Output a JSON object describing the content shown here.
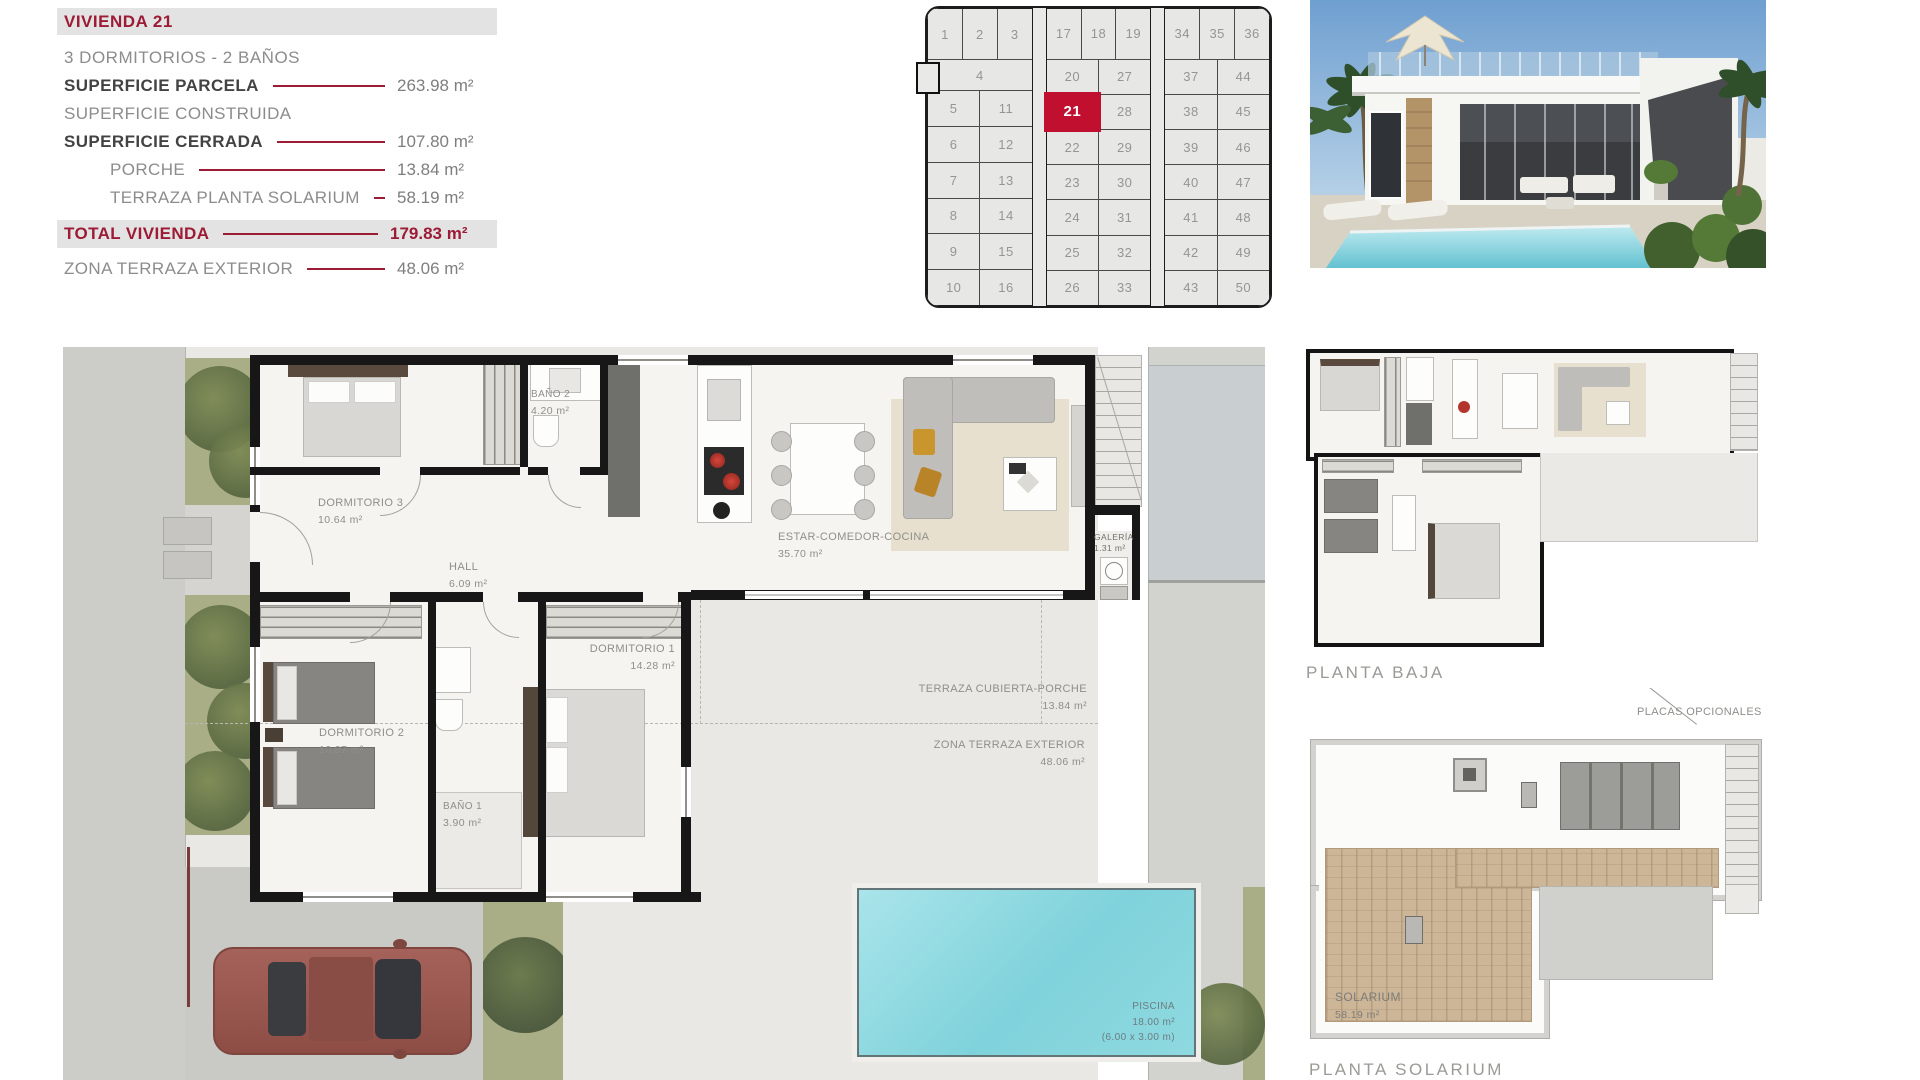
{
  "theme": {
    "accent_red": "#9c1b35",
    "highlight_red": "#c10f2f",
    "text_gray": "#8c8c8c",
    "panel_gray": "#e3e3e3",
    "pool_blue": "#7fd2db"
  },
  "info_panel": {
    "title": "VIVIENDA 21",
    "subtitle": "3 DORMITORIOS - 2 BAÑOS",
    "rows": [
      {
        "label": "SUPERFICIE PARCELA",
        "value": "263.98 m²"
      },
      {
        "label": "SUPERFICIE CONSTRUIDA",
        "value": ""
      },
      {
        "label": "SUPERFICIE CERRADA",
        "value": "107.80 m²"
      },
      {
        "label": "PORCHE",
        "value": "13.84 m²"
      },
      {
        "label": "TERRAZA PLANTA SOLARIUM",
        "value": "58.19 m²"
      }
    ],
    "total": {
      "label": "TOTAL VIVIENDA",
      "value": "179.83 m²"
    },
    "footer": {
      "label": "ZONA TERRAZA EXTERIOR",
      "value": "48.06 m²"
    }
  },
  "site_plan": {
    "highlighted_unit": "21",
    "blocks": [
      {
        "rows": [
          [
            "1",
            "2",
            "3"
          ],
          [
            "4"
          ],
          [
            "5",
            "11"
          ],
          [
            "6",
            "12"
          ],
          [
            "7",
            "13"
          ],
          [
            "8",
            "14"
          ],
          [
            "9",
            "15"
          ],
          [
            "10",
            "16"
          ]
        ]
      },
      {
        "rows": [
          [
            "17",
            "18",
            "19"
          ],
          [
            "20",
            "27"
          ],
          [
            "21",
            "28"
          ],
          [
            "22",
            "29"
          ],
          [
            "23",
            "30"
          ],
          [
            "24",
            "31"
          ],
          [
            "25",
            "32"
          ],
          [
            "26",
            "33"
          ]
        ]
      },
      {
        "rows": [
          [
            "34",
            "35",
            "36"
          ],
          [
            "37",
            "44"
          ],
          [
            "38",
            "45"
          ],
          [
            "39",
            "46"
          ],
          [
            "40",
            "47"
          ],
          [
            "41",
            "48"
          ],
          [
            "42",
            "49"
          ],
          [
            "43",
            "50"
          ]
        ]
      }
    ]
  },
  "floor_plan": {
    "labels": {
      "dormitorio3": {
        "name": "DORMITORIO 3",
        "area": "10.64 m²"
      },
      "bano2": {
        "name": "BAÑO 2",
        "area": "4.20 m²"
      },
      "hall": {
        "name": "HALL",
        "area": "6.09 m²"
      },
      "estar": {
        "name": "ESTAR-COMEDOR-COCINA",
        "area": "35.70 m²"
      },
      "galeria": {
        "name": "GALERÍA",
        "area": "1.31 m²"
      },
      "dormitorio2": {
        "name": "DORMITORIO 2",
        "area": "10.87 m²"
      },
      "bano1": {
        "name": "BAÑO 1",
        "area": "3.90 m²"
      },
      "dormitorio1": {
        "name": "DORMITORIO 1",
        "area": "14.28 m²"
      },
      "porche": {
        "name": "TERRAZA CUBIERTA-PORCHE",
        "area": "13.84 m²"
      },
      "zona_terraza": {
        "name": "ZONA TERRAZA EXTERIOR",
        "area": "48.06 m²"
      },
      "piscina": {
        "name": "PISCINA",
        "area": "18.00 m²",
        "dims": "(6.00 x 3.00 m)"
      }
    }
  },
  "plans": {
    "planta_baja_label": "PLANTA BAJA",
    "planta_solarium_label": "PLANTA SOLARIUM",
    "placas_label": "PLACAS OPCIONALES",
    "solarium": {
      "name": "SOLARIUM",
      "area": "58.19 m²"
    }
  }
}
